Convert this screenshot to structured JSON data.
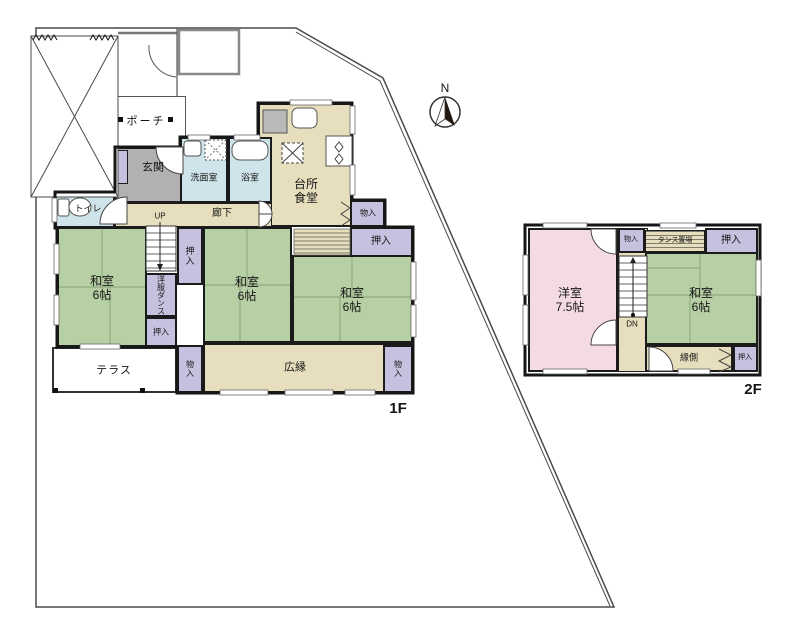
{
  "meta": {
    "floor1_label": "1F",
    "floor2_label": "2F",
    "north_label": "N"
  },
  "labels": {
    "porch": "ポーチ",
    "genkan": "玄関",
    "washroom": "洗面室",
    "bathroom": "浴室",
    "kitchen_dining": "台所\n食堂",
    "hallway": "廊下",
    "toilet": "トイレ",
    "up": "UP",
    "dn": "DN",
    "washitsu6": "和室\n6帖",
    "yoshitsu75": "洋室\n7.5帖",
    "oshiire": "押入",
    "monoire": "物入",
    "wardrobe_col1": "洋服",
    "wardrobe_col2": "ダンス",
    "tansu_okiba": "タンス置場",
    "terrace": "テラス",
    "hiroen": "広縁",
    "engawa": "縁側"
  },
  "colors": {
    "tatami_green": "#b6cfa4",
    "wood_beige": "#e7debd",
    "water_blue": "#cfe4ea",
    "closet_lavender": "#c5c1df",
    "western_pink": "#f4dbe3",
    "genkan_gray": "#b2b0b0",
    "wall_black": "#1b1b1b",
    "boundary_gray": "#4a4a4a"
  }
}
